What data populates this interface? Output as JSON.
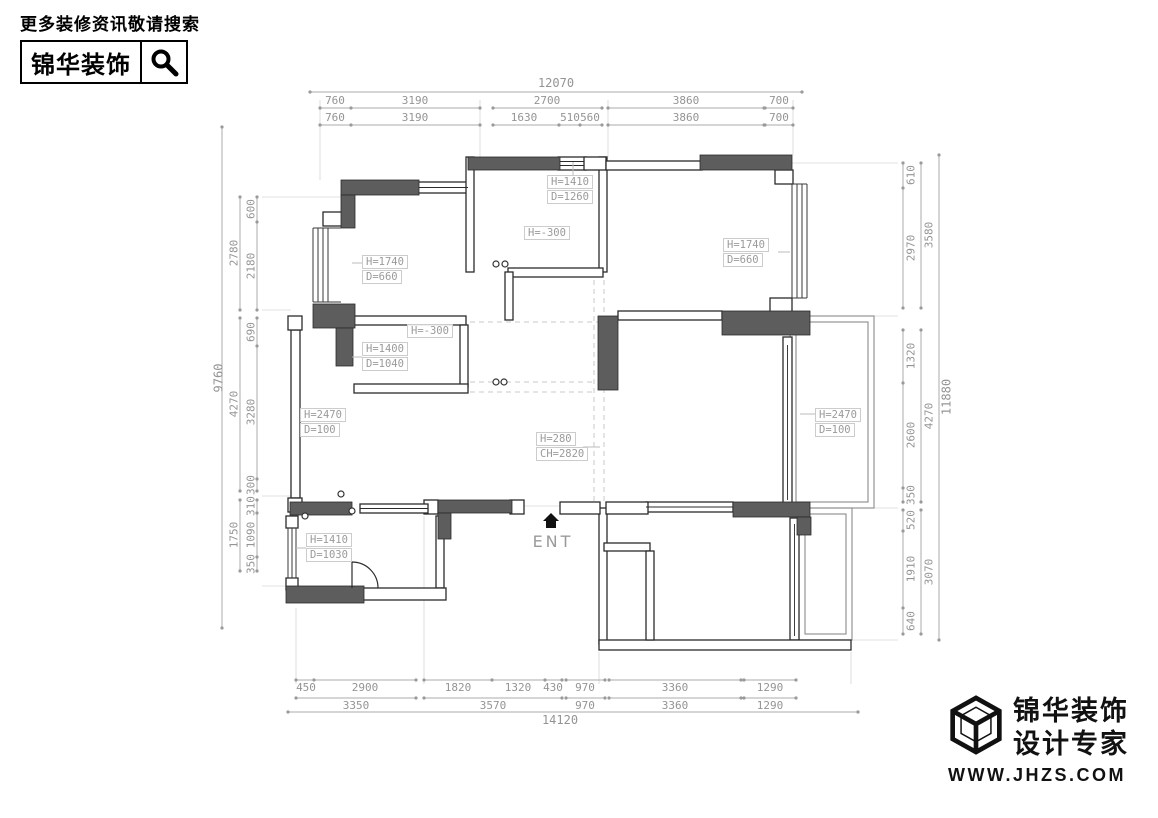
{
  "header": {
    "tagline": "更多装修资讯敬请搜索",
    "brand": "锦华装饰"
  },
  "footer": {
    "brand_line1": "锦华装饰",
    "brand_line2": "设计专家",
    "website": "WWW.JHZS.COM"
  },
  "icons": {
    "header_search": "magnifier-icon",
    "footer_logo": "cube-wireframe-icon",
    "entrance": "home-arrow-icon"
  },
  "colors": {
    "wall_fill": "#5d5d5d",
    "wall_line": "#2b2b2b",
    "dim_text": "#949494",
    "dashed_guide": "#c8c8c8",
    "logo": "#111111"
  },
  "plan": {
    "entrance_label": "ENT",
    "annotations": [
      {
        "id": "a1",
        "lines": [
          "H=1410",
          "D=1260"
        ]
      },
      {
        "id": "a2",
        "lines": [
          "H=-300"
        ]
      },
      {
        "id": "a3",
        "lines": [
          "H=1740",
          "D=660"
        ]
      },
      {
        "id": "a4",
        "lines": [
          "H=1740",
          "D=660"
        ]
      },
      {
        "id": "a5",
        "lines": [
          "H=-300"
        ]
      },
      {
        "id": "a6",
        "lines": [
          "H=1400",
          "D=1040"
        ]
      },
      {
        "id": "a7",
        "lines": [
          "H=2470",
          "D=100"
        ]
      },
      {
        "id": "a8",
        "lines": [
          "H=280",
          "CH=2820"
        ]
      },
      {
        "id": "a9",
        "lines": [
          "H=2470",
          "D=100"
        ]
      },
      {
        "id": "a10",
        "lines": [
          "H=1410",
          "D=1030"
        ]
      }
    ],
    "dimensions": {
      "top": {
        "total": "12070",
        "row1": [
          "760",
          "3190",
          "2700",
          "3860",
          "700"
        ],
        "row2": [
          "760",
          "3190",
          "1630",
          "510",
          "560",
          "3860",
          "700"
        ]
      },
      "bottom": {
        "row1": [
          "450",
          "2900",
          "1820",
          "1320",
          "430",
          "970",
          "3360",
          "1290"
        ],
        "row2": [
          "3350",
          "3570",
          "970",
          "3360",
          "1290"
        ],
        "total": "14120"
      },
      "left": {
        "outer": "9760",
        "mid": [
          "2780",
          "4270",
          "1750"
        ],
        "inner": [
          "600",
          "2180",
          "690",
          "3280",
          "300",
          "310",
          "1090",
          "350"
        ]
      },
      "right": {
        "outer": "11880",
        "mid": [
          "3580",
          "4270",
          "3070"
        ],
        "inner": [
          "610",
          "2970",
          "1320",
          "2600",
          "350",
          "520",
          "1910",
          "640"
        ]
      }
    }
  }
}
